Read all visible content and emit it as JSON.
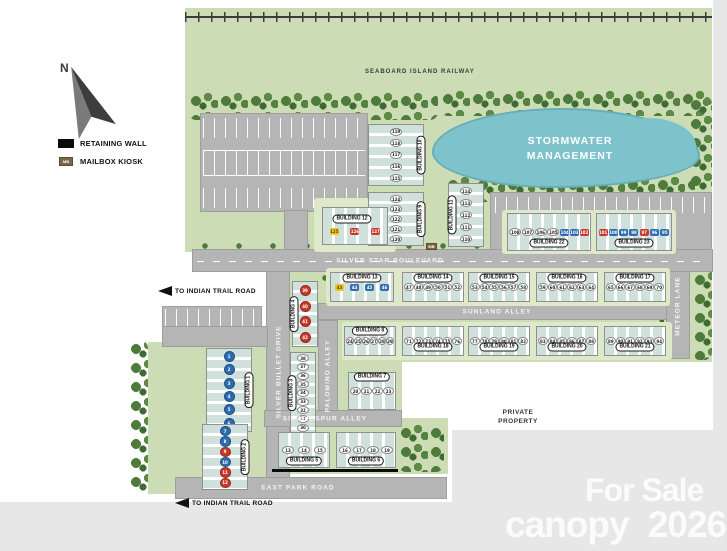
{
  "compass": {
    "label": "N"
  },
  "legend": {
    "retaining_wall_label": "RETAINING WALL",
    "mailbox_label": "MAILBOX KIOSK",
    "mailbox_abbr": "MB"
  },
  "railway": {
    "label": "SEABOARD ISLAND RAILWAY"
  },
  "pond": {
    "line1": "STORMWATER",
    "line2": "MANAGEMENT"
  },
  "roads": {
    "silver_star": "SILVER STAR BOULEVARD",
    "sunland": "SUNLAND ALLEY",
    "silver_spur": "SILVER SPUR ALLEY",
    "east_park": "EAST PARK ROAD",
    "silver_bullet": "SILVER BULLET DRIVE",
    "palomino": "PALOMINO ALLEY",
    "meteor": "METEOR LANE"
  },
  "directions": {
    "west": "TO INDIAN TRAIL ROAD",
    "south": "TO INDIAN TRAIL ROAD"
  },
  "notes": {
    "private_property": [
      "PRIVATE",
      "PROPERTY"
    ]
  },
  "mailbox_kiosk": {
    "abbr": "MB"
  },
  "watermark": {
    "for_sale": "For Sale",
    "brand": "canopy",
    "year": "2026"
  },
  "colors": {
    "available_unit": "#ffffff",
    "blue_unit": "#2e6cb0",
    "red_unit": "#c8392c",
    "yellow_unit": "#f1c12b",
    "pond": "#7ec2cc",
    "green": "#ccdcb4",
    "road": "#b5b5b5"
  },
  "buildings": {
    "b1": {
      "label": "BUILDING 1",
      "units": [
        {
          "n": "1",
          "c": "dot-blue"
        },
        {
          "n": "2",
          "c": "dot-blue"
        },
        {
          "n": "3",
          "c": "dot-blue"
        },
        {
          "n": "4",
          "c": "dot-blue"
        },
        {
          "n": "5",
          "c": "dot-blue"
        },
        {
          "n": "6",
          "c": "dot-blue"
        }
      ]
    },
    "b2": {
      "label": "BUILDING 2",
      "units": [
        {
          "n": "7",
          "c": "dot-blue"
        },
        {
          "n": "8",
          "c": "dot-blue"
        },
        {
          "n": "9",
          "c": "dot-red"
        },
        {
          "n": "10",
          "c": "dot-blue"
        },
        {
          "n": "11",
          "c": "dot-red"
        },
        {
          "n": "12",
          "c": "dot-red"
        }
      ]
    },
    "b3": {
      "label": "BUILDING 3",
      "units": [
        {
          "n": "38",
          "c": "ov"
        },
        {
          "n": "37",
          "c": "ov"
        },
        {
          "n": "36",
          "c": "ov"
        },
        {
          "n": "35",
          "c": "ov"
        },
        {
          "n": "34",
          "c": "ov"
        },
        {
          "n": "33",
          "c": "ov"
        },
        {
          "n": "32",
          "c": "ov"
        },
        {
          "n": "31",
          "c": "ov"
        },
        {
          "n": "30",
          "c": "ov"
        }
      ]
    },
    "b4": {
      "label": "BUILDING 4",
      "units": [
        {
          "n": "39",
          "c": "dot-red"
        },
        {
          "n": "40",
          "c": "dot-red"
        },
        {
          "n": "41",
          "c": "dot-red"
        },
        {
          "n": "42",
          "c": "dot-red"
        }
      ]
    },
    "b5": {
      "label": "BUILDING 5",
      "units": [
        {
          "n": "13",
          "c": "ov"
        },
        {
          "n": "14",
          "c": "ov"
        },
        {
          "n": "15",
          "c": "ov"
        }
      ]
    },
    "b6": {
      "label": "BUILDING 6",
      "units": [
        {
          "n": "16",
          "c": "ov"
        },
        {
          "n": "17",
          "c": "ov"
        },
        {
          "n": "18",
          "c": "ov"
        },
        {
          "n": "19",
          "c": "ov"
        }
      ]
    },
    "b7": {
      "label": "BUILDING 7",
      "units": [
        {
          "n": "20",
          "c": "ov"
        },
        {
          "n": "21",
          "c": "ov"
        },
        {
          "n": "22",
          "c": "ov"
        },
        {
          "n": "23",
          "c": "ov"
        }
      ]
    },
    "b8": {
      "label": "BUILDING 8",
      "units": [
        {
          "n": "24",
          "c": "ov"
        },
        {
          "n": "25",
          "c": "ov"
        },
        {
          "n": "26",
          "c": "ov"
        },
        {
          "n": "27",
          "c": "ov"
        },
        {
          "n": "28",
          "c": "ov"
        },
        {
          "n": "29",
          "c": "ov"
        }
      ]
    },
    "b9": {
      "label": "BUILDING 9",
      "units": [
        {
          "n": "124",
          "c": "ov"
        },
        {
          "n": "123",
          "c": "ov"
        },
        {
          "n": "122",
          "c": "ov"
        },
        {
          "n": "121",
          "c": "ov"
        },
        {
          "n": "120",
          "c": "ov"
        }
      ]
    },
    "b10": {
      "label": "BUILDING 10",
      "units": [
        {
          "n": "119",
          "c": "ov"
        },
        {
          "n": "118",
          "c": "ov"
        },
        {
          "n": "117",
          "c": "ov"
        },
        {
          "n": "116",
          "c": "ov"
        },
        {
          "n": "115",
          "c": "ov"
        }
      ]
    },
    "b11": {
      "label": "BUILDING 11",
      "units": [
        {
          "n": "114",
          "c": "ov"
        },
        {
          "n": "113",
          "c": "ov"
        },
        {
          "n": "112",
          "c": "ov"
        },
        {
          "n": "111",
          "c": "ov"
        },
        {
          "n": "110",
          "c": "ov"
        }
      ]
    },
    "b12": {
      "label": "BUILDING 12",
      "units": [
        {
          "n": "125",
          "c": "sq-yellow"
        },
        {
          "n": "126",
          "c": "sq-red"
        },
        {
          "n": "127",
          "c": "sq-red"
        }
      ]
    },
    "b13": {
      "label": "BUILDING 13",
      "units": [
        {
          "n": "43",
          "c": "sq-yellow"
        },
        {
          "n": "44",
          "c": "sq-blue"
        },
        {
          "n": "45",
          "c": "sq-blue"
        },
        {
          "n": "46",
          "c": "sq-blue"
        }
      ]
    },
    "b14": {
      "label": "BUILDING 14",
      "units": [
        {
          "n": "47",
          "c": "ov"
        },
        {
          "n": "48",
          "c": "ov"
        },
        {
          "n": "49",
          "c": "ov"
        },
        {
          "n": "50",
          "c": "ov"
        },
        {
          "n": "51",
          "c": "ov"
        },
        {
          "n": "52",
          "c": "ov"
        }
      ]
    },
    "b15": {
      "label": "BUILDING 15",
      "units": [
        {
          "n": "53",
          "c": "ov"
        },
        {
          "n": "54",
          "c": "ov"
        },
        {
          "n": "55",
          "c": "ov"
        },
        {
          "n": "56",
          "c": "ov"
        },
        {
          "n": "57",
          "c": "ov"
        },
        {
          "n": "58",
          "c": "ov"
        }
      ]
    },
    "b16": {
      "label": "BUILDING 16",
      "units": [
        {
          "n": "59",
          "c": "ov"
        },
        {
          "n": "60",
          "c": "ov"
        },
        {
          "n": "61",
          "c": "ov"
        },
        {
          "n": "62",
          "c": "ov"
        },
        {
          "n": "63",
          "c": "ov"
        },
        {
          "n": "64",
          "c": "ov"
        }
      ]
    },
    "b17": {
      "label": "BUILDING 17",
      "units": [
        {
          "n": "65",
          "c": "ov"
        },
        {
          "n": "66",
          "c": "ov"
        },
        {
          "n": "67",
          "c": "ov"
        },
        {
          "n": "68",
          "c": "ov"
        },
        {
          "n": "69",
          "c": "ov"
        },
        {
          "n": "70",
          "c": "ov"
        }
      ]
    },
    "b18": {
      "label": "BUILDING 18",
      "units": [
        {
          "n": "71",
          "c": "ov"
        },
        {
          "n": "72",
          "c": "ov"
        },
        {
          "n": "73",
          "c": "ov"
        },
        {
          "n": "74",
          "c": "ov"
        },
        {
          "n": "75",
          "c": "ov"
        },
        {
          "n": "76",
          "c": "ov"
        }
      ]
    },
    "b19": {
      "label": "BUILDING 19",
      "units": [
        {
          "n": "77",
          "c": "ov"
        },
        {
          "n": "78",
          "c": "ov"
        },
        {
          "n": "79",
          "c": "ov"
        },
        {
          "n": "80",
          "c": "ov"
        },
        {
          "n": "81",
          "c": "ov"
        },
        {
          "n": "82",
          "c": "ov"
        }
      ]
    },
    "b20": {
      "label": "BUILDING 20",
      "units": [
        {
          "n": "83",
          "c": "ov"
        },
        {
          "n": "84",
          "c": "ov"
        },
        {
          "n": "85",
          "c": "ov"
        },
        {
          "n": "86",
          "c": "ov"
        },
        {
          "n": "87",
          "c": "ov"
        },
        {
          "n": "88",
          "c": "ov"
        }
      ]
    },
    "b21": {
      "label": "BUILDING 21",
      "units": [
        {
          "n": "89",
          "c": "ov"
        },
        {
          "n": "90",
          "c": "ov"
        },
        {
          "n": "91",
          "c": "ov"
        },
        {
          "n": "92",
          "c": "ov"
        },
        {
          "n": "93",
          "c": "ov"
        },
        {
          "n": "94",
          "c": "ov"
        }
      ]
    },
    "b22": {
      "label": "BUILDING 22",
      "units": [
        {
          "n": "108",
          "c": "ov"
        },
        {
          "n": "107",
          "c": "ov"
        },
        {
          "n": "106",
          "c": "ov"
        },
        {
          "n": "105",
          "c": "ov"
        },
        {
          "n": "104",
          "c": "sq-blue"
        },
        {
          "n": "103",
          "c": "sq-blue"
        },
        {
          "n": "102",
          "c": "sq-red"
        }
      ]
    },
    "b23": {
      "label": "BUILDING 23",
      "units": [
        {
          "n": "101",
          "c": "sq-red"
        },
        {
          "n": "100",
          "c": "sq-blue"
        },
        {
          "n": "99",
          "c": "sq-blue"
        },
        {
          "n": "98",
          "c": "sq-blue"
        },
        {
          "n": "97",
          "c": "sq-red"
        },
        {
          "n": "96",
          "c": "sq-blue"
        },
        {
          "n": "95",
          "c": "sq-blue"
        }
      ]
    }
  }
}
